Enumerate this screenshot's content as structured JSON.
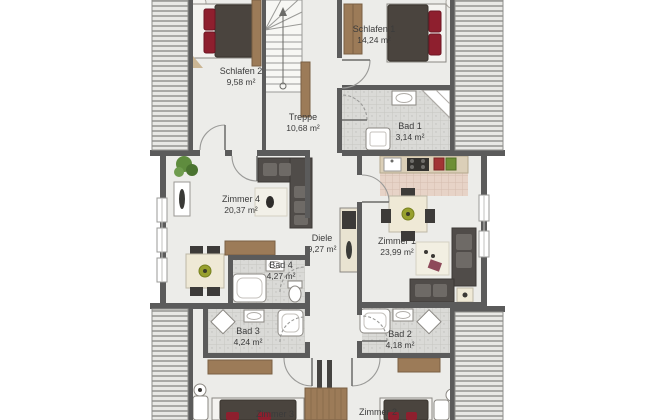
{
  "rooms": {
    "schlafen2": {
      "name": "Schlafen 2",
      "area": "9,58 m²"
    },
    "treppe": {
      "name": "Treppe",
      "area": "10,68 m²"
    },
    "schlafen1": {
      "name": "Schlafen 1",
      "area": "14,24 m²"
    },
    "bad1": {
      "name": "Bad 1",
      "area": "3,14 m²"
    },
    "zimmer4": {
      "name": "Zimmer 4",
      "area": "20,37 m²"
    },
    "diele": {
      "name": "Diele",
      "area": "9,27 m²"
    },
    "zimmer1": {
      "name": "Zimmer 1",
      "area": "23,99 m²"
    },
    "bad4": {
      "name": "Bad 4",
      "area": "4,27 m²"
    },
    "bad3": {
      "name": "Bad 3",
      "area": "4,24 m²"
    },
    "bad2": {
      "name": "Bad 2",
      "area": "4,18 m²"
    },
    "zimmer3": {
      "name": "Zimmer 3"
    },
    "zimmer2": {
      "name": "Zimmer 2"
    }
  },
  "colors": {
    "wall": "#5b5b5b",
    "floor": "#ecece9",
    "hatch_line": "#a9a9a6",
    "wood": "#9c7b58",
    "bed_duvet": "#4a443e",
    "pillow_red": "#8e1f2e",
    "sofa": "#504c49",
    "table_top": "#efe9d6",
    "plant_green": "#5f8c3e",
    "tile": "#dadad7",
    "kitchen_tile": "#e7d3c7",
    "label_text": "#3b3b3b"
  }
}
